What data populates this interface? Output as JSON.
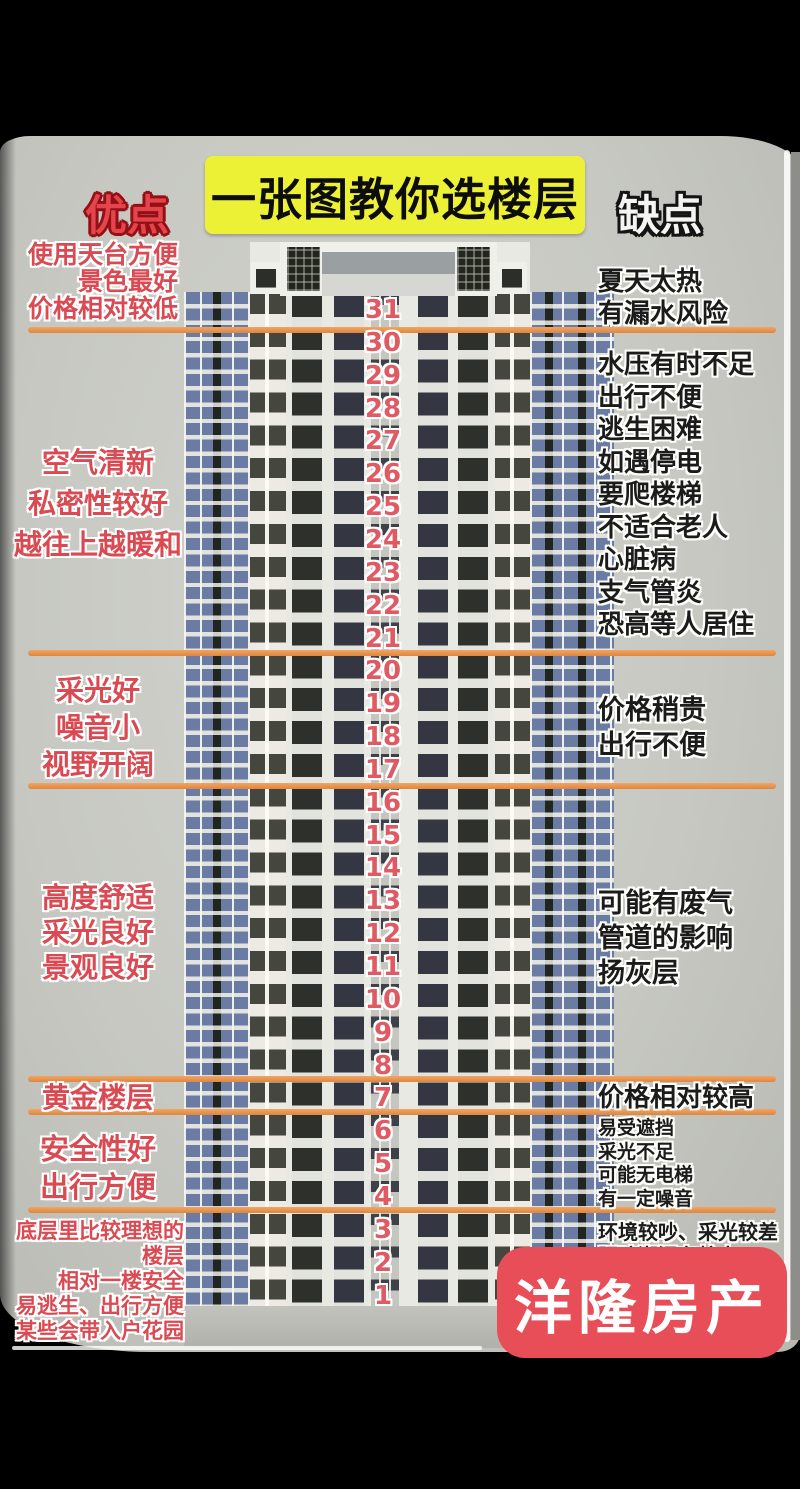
{
  "header": {
    "advantages_label": "优点",
    "title": "一张图教你选楼层",
    "disadvantages_label": "缺点"
  },
  "building": {
    "floor_numbers": [
      31,
      30,
      29,
      28,
      27,
      26,
      25,
      24,
      23,
      22,
      21,
      20,
      19,
      18,
      17,
      16,
      15,
      14,
      13,
      12,
      11,
      10,
      9,
      8,
      7,
      6,
      5,
      4,
      3,
      2,
      1
    ]
  },
  "advantages": [
    [
      "使用天台方便",
      "景色最好",
      "价格相对较低"
    ],
    [
      "空气清新",
      "私密性较好",
      "越往上越暖和"
    ],
    [
      "采光好",
      "噪音小",
      "视野开阔"
    ],
    [
      "高度舒适",
      "采光良好",
      "景观良好"
    ],
    [
      "黄金楼层"
    ],
    [
      "安全性好",
      "出行方便"
    ],
    [
      "底层里比较理想的楼层",
      "相对一楼安全",
      "易逃生、出行方便",
      "某些会带入户花园"
    ]
  ],
  "disadvantages": [
    [
      "夏天太热",
      "有漏水风险"
    ],
    [
      "水压有时不足",
      "出行不便",
      "逃生困难",
      "如遇停电",
      "要爬楼梯",
      "不适合老人",
      "心脏病",
      "支气管炎",
      "恐高等人居住"
    ],
    [
      "价格稍贵",
      "出行不便"
    ],
    [
      "可能有废气",
      "管道的影响",
      "扬灰层"
    ],
    [
      "价格相对较高"
    ],
    [
      "易受遮挡",
      "采光不足",
      "可能无电梯",
      "有一定噪音"
    ],
    [
      "环境较吵、采光较差",
      "阴暗潮湿有蚊虫"
    ]
  ],
  "watermark": {
    "text": "洋隆房产"
  },
  "colors": {
    "divider_orange": "#ec9753",
    "advantage_red": "#d94a52",
    "title_yellow": "#edf136",
    "floor_number_red": "#df5a63",
    "watermark_red": "#e84e57"
  }
}
